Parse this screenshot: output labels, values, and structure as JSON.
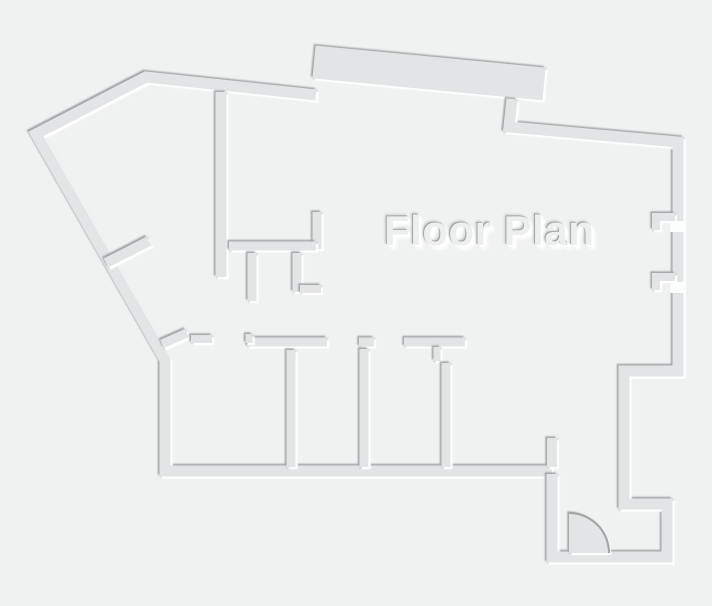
{
  "canvas": {
    "width": 712,
    "height": 606,
    "background": "#f0f1f1"
  },
  "palette": {
    "wall_fill": "#e2e4e5",
    "edge_dark": "#9fa3a4",
    "edge_light": "#ffffff",
    "opening_fill": "#fcfdfd",
    "title_color": "#edefef"
  },
  "title": {
    "text": "Floor Plan"
  },
  "walls": [
    {
      "name": "top-band-wall",
      "width": 33,
      "points": [
        [
          314,
          62
        ],
        [
          544,
          84
        ]
      ]
    },
    {
      "name": "outer-wall-west",
      "width": 11,
      "points": [
        [
          316,
          95
        ],
        [
          146,
          77
        ],
        [
          36,
          134
        ],
        [
          165,
          360
        ],
        [
          165,
          471
        ],
        [
          552,
          471
        ]
      ]
    },
    {
      "name": "outer-wall-east",
      "width": 11,
      "points": [
        [
          512,
          99
        ],
        [
          509,
          127
        ],
        [
          678,
          142
        ],
        [
          678,
          371
        ],
        [
          624,
          371
        ],
        [
          624,
          504
        ],
        [
          667,
          504
        ],
        [
          667,
          557
        ],
        [
          552,
          557
        ],
        [
          552,
          474
        ]
      ]
    },
    {
      "name": "hall-wall-vertical",
      "width": 11,
      "points": [
        [
          221,
          92
        ],
        [
          221,
          277
        ]
      ]
    },
    {
      "name": "closet-wall-right",
      "width": 9,
      "points": [
        [
          317,
          212
        ],
        [
          317,
          249
        ]
      ]
    },
    {
      "name": "closet-wall-horizontal",
      "width": 9,
      "points": [
        [
          229,
          246
        ],
        [
          316,
          246
        ]
      ]
    },
    {
      "name": "closet-stub-left",
      "width": 9,
      "points": [
        [
          252,
          253
        ],
        [
          252,
          301
        ]
      ]
    },
    {
      "name": "closet-stub-right",
      "width": 9,
      "points": [
        [
          297,
          253
        ],
        [
          297,
          292
        ]
      ]
    },
    {
      "name": "closet-stub-bottom",
      "width": 8,
      "points": [
        [
          300,
          289
        ],
        [
          321,
          289
        ]
      ]
    },
    {
      "name": "west-diagonal-stub",
      "width": 10,
      "points": [
        [
          106,
          263
        ],
        [
          149,
          241
        ]
      ]
    },
    {
      "name": "corridor-jamb-diagonal",
      "width": 9,
      "points": [
        [
          162,
          344
        ],
        [
          187,
          333
        ]
      ]
    },
    {
      "name": "corridor-jamb-horizontal",
      "width": 8,
      "points": [
        [
          191,
          339
        ],
        [
          212,
          339
        ]
      ]
    },
    {
      "name": "room1-wall-top",
      "width": 9,
      "points": [
        [
          247,
          342
        ],
        [
          327,
          342
        ]
      ]
    },
    {
      "name": "room1-wall-step",
      "width": 7,
      "points": [
        [
          249,
          334
        ],
        [
          249,
          343
        ]
      ]
    },
    {
      "name": "room2-jamb",
      "width": 9,
      "points": [
        [
          359,
          342
        ],
        [
          374,
          342
        ]
      ]
    },
    {
      "name": "room3-wall-top",
      "width": 9,
      "points": [
        [
          404,
          342
        ],
        [
          465,
          342
        ]
      ]
    },
    {
      "name": "room3-door-stub",
      "width": 7,
      "points": [
        [
          437,
          347
        ],
        [
          437,
          361
        ]
      ]
    },
    {
      "name": "partition-wall-1",
      "width": 9,
      "points": [
        [
          291,
          350
        ],
        [
          291,
          467
        ]
      ]
    },
    {
      "name": "partition-wall-2",
      "width": 9,
      "points": [
        [
          364,
          349
        ],
        [
          364,
          467
        ]
      ]
    },
    {
      "name": "partition-wall-3",
      "width": 9,
      "points": [
        [
          446,
          363
        ],
        [
          446,
          467
        ]
      ]
    },
    {
      "name": "entry-jamb-stub",
      "width": 10,
      "points": [
        [
          552,
          438
        ],
        [
          552,
          467
        ]
      ]
    },
    {
      "name": "window-notch-upper",
      "width": 8,
      "points": [
        [
          675,
          217
        ],
        [
          656,
          217
        ],
        [
          656,
          230
        ]
      ]
    },
    {
      "name": "window-notch-lower",
      "width": 8,
      "points": [
        [
          675,
          277
        ],
        [
          656,
          277
        ],
        [
          656,
          290
        ]
      ]
    }
  ],
  "openings": [
    {
      "name": "door-gap-upper",
      "x": 670,
      "y": 221,
      "w": 16,
      "h": 11
    },
    {
      "name": "door-gap-lower",
      "x": 670,
      "y": 282,
      "w": 16,
      "h": 11
    }
  ],
  "door": {
    "hinge": [
      569,
      553
    ],
    "radius": 40
  }
}
